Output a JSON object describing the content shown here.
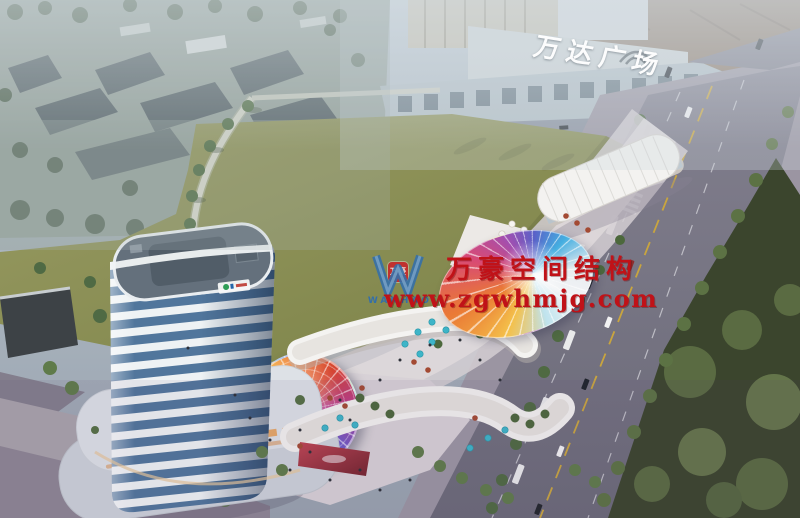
{
  "signs": {
    "mall_roof_sign": "万达广场"
  },
  "watermark": {
    "logo_text": "WANHAO",
    "badge_text": "万豪",
    "line1": "万豪空间结构",
    "line2": "www.zgwhmjg.com",
    "color": "#c01218",
    "logo_color": "#2a6cb5"
  },
  "colors": {
    "sky_haze": "#aeb9c3",
    "field": "#8f9159",
    "lawn": "#3b452d",
    "road": "#76747f",
    "sidewalk": "#a19baa",
    "tower_band_white": "#eef2f4",
    "tower_glass": "#51769c",
    "retail_white": "#f2f1ef",
    "umbrella_teal": "#3eb5c8",
    "led_screen": "#a83a48",
    "mall_roof": "#ced4d6",
    "old_town_roof": "#8d7968",
    "watermark_red": "#c01218",
    "logo_blue": "#2a6cb5"
  },
  "palettes": {
    "dome": [
      "#3fb0e0",
      "#7fd4d8",
      "#f0e04a",
      "#ef8438",
      "#d6452f",
      "#b83b8e",
      "#6a5bc8"
    ],
    "canopy": [
      "#f2f4f6",
      "#bfe3ee",
      "#f4c04a",
      "#ea7a35",
      "#d84a74",
      "#a24fb0",
      "#5a62c8",
      "#44aee0"
    ]
  }
}
